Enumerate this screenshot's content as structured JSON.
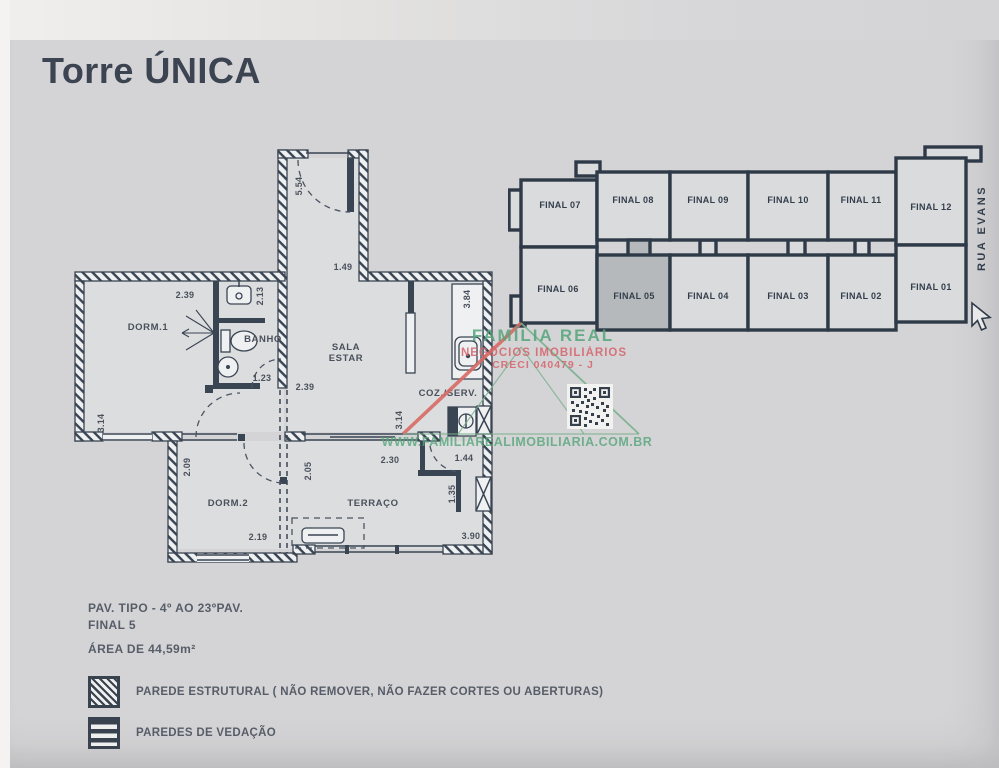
{
  "title": "Torre ÚNICA",
  "plan": {
    "rooms": {
      "dorm1": "DORM.1",
      "banho": "BANHO",
      "sala1": "SALA",
      "sala2": "ESTAR",
      "coz": "COZ./SERV.",
      "dorm2": "DORM.2",
      "terraco": "TERRAÇO"
    },
    "dims": {
      "hall_h": "5.54",
      "hall_w": "1.49",
      "dorm1_w": "2.39",
      "banho_w": "2.13",
      "banho_d": "1.23",
      "sala_w": "2.39",
      "coz_h": "3.84",
      "dorm1_h": "3.14",
      "sala_h": "3.14",
      "dorm2_h": "2.09",
      "terraco_l": "2.05",
      "terraco_w": "2.30",
      "serv_door": "1.44",
      "serv_h": "1.35",
      "dorm2_w": "2.19",
      "terraco_bw": "3.90"
    }
  },
  "key_plan": {
    "units_top": [
      "FINAL 07",
      "FINAL 08",
      "FINAL 09",
      "FINAL 10",
      "FINAL 11",
      "FINAL 12"
    ],
    "units_bottom": [
      "FINAL 06",
      "FINAL 05",
      "FINAL 04",
      "FINAL 03",
      "FINAL 02",
      "FINAL 01"
    ],
    "highlighted_unit": "FINAL 05",
    "street": "RUA EVANS"
  },
  "watermark": {
    "brand": "FAMÍLIA REAL",
    "line2": "NEGÓCIOS IMOBILIÁRIOS",
    "creci": "CRECI 040479 - J",
    "site": "WWW.FAMILIAREALIMOBILIARIA.COM.BR"
  },
  "info": {
    "pav": "PAV. TIPO - 4º AO 23ºPAV.",
    "final": "FINAL 5",
    "area": "ÁREA DE 44,59m²"
  },
  "legend": {
    "structural": "PAREDE ESTRUTURAL  ( NÃO REMOVER, NÃO FAZER CORTES OU ABERTURAS)",
    "vedacao": "PAREDES DE VEDAÇÃO"
  },
  "colors": {
    "background": "#d4d4d6",
    "ink": "#3a4553",
    "accent_green": "#55a57a",
    "accent_red": "#d4646a",
    "highlight_unit": "#b6b9bb"
  }
}
